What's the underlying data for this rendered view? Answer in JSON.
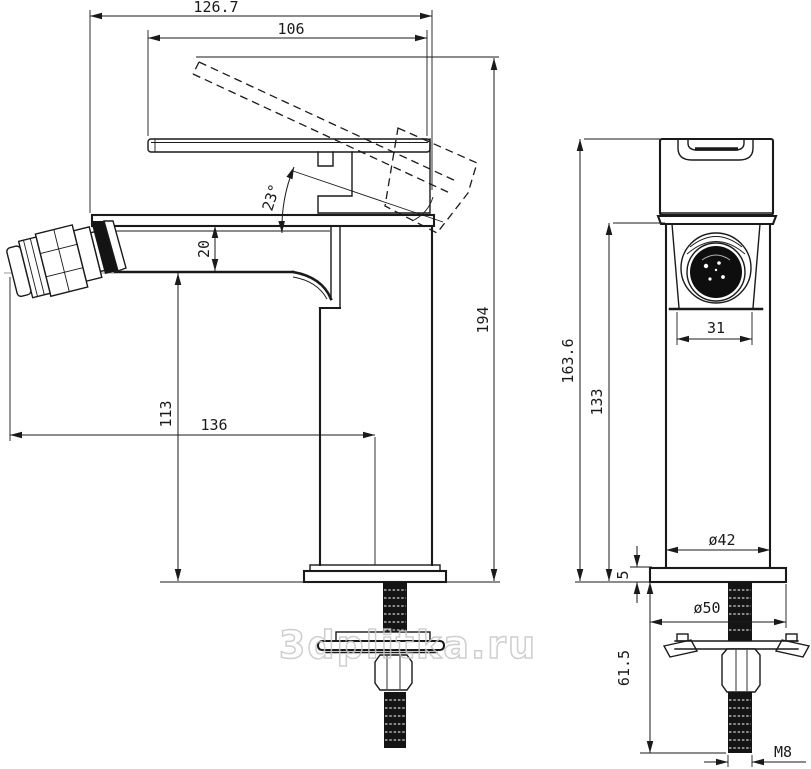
{
  "watermark": "3dplitka.ru",
  "front_view": {
    "dims": {
      "overall_width": "126.7",
      "handle_length": "106",
      "handle_angle": "23°",
      "spout_body_height": "20",
      "overall_height": "194",
      "spout_underside_height": "113",
      "spout_reach": "136"
    }
  },
  "side_view": {
    "dims": {
      "height_overall": "163.6",
      "height_body": "133",
      "aerator_width": "31",
      "body_diameter": "ø42",
      "base_thickness": "5",
      "base_diameter": "ø50",
      "stud_length": "61.5",
      "thread_size": "M8"
    }
  }
}
